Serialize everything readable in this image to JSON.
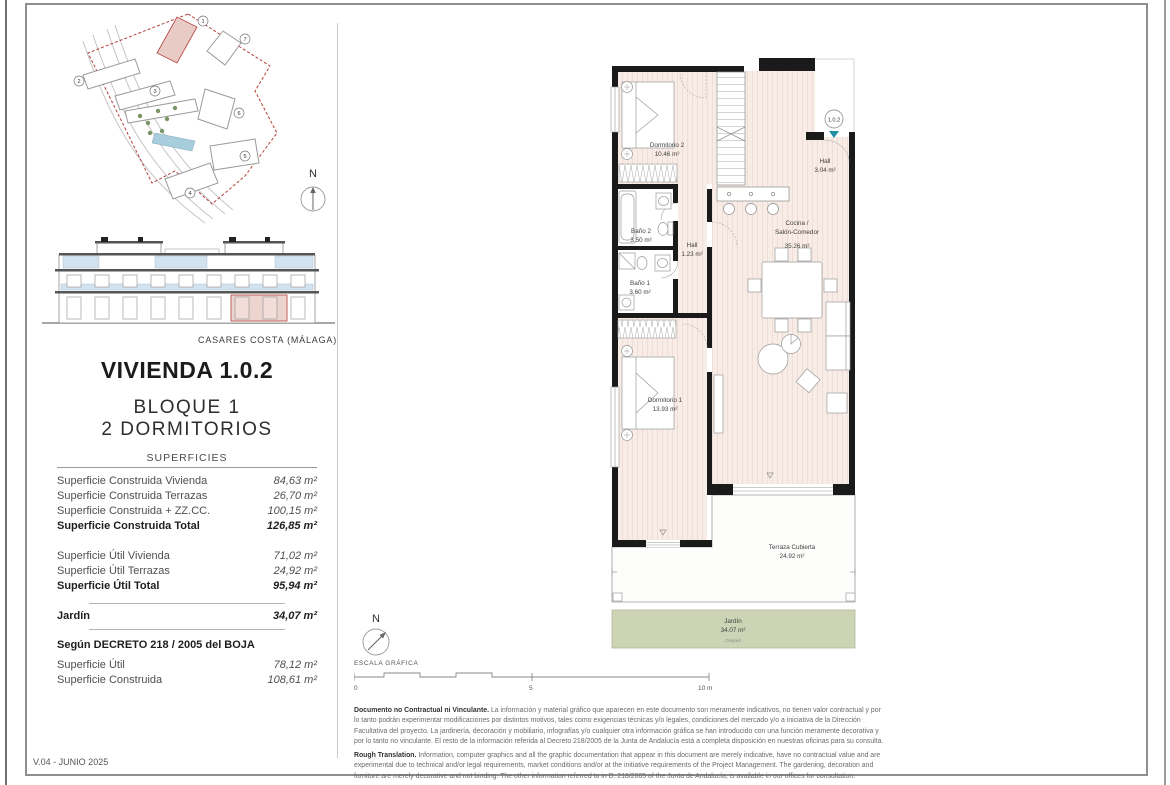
{
  "meta": {
    "version": "V.04 - JUNIO 2025",
    "location": "CASARES COSTA (MÁLAGA)"
  },
  "unit": {
    "title": "VIVIENDA 1.0.2",
    "block": "BLOQUE 1",
    "type": "2 DORMITORIOS",
    "marker": "1.0.2"
  },
  "north": {
    "label": "N"
  },
  "surfaces": {
    "heading": "SUPERFICIES",
    "rows": [
      {
        "label": "Superficie Construida Vivienda",
        "value": "84,63 m²"
      },
      {
        "label": "Superficie Construida Terrazas",
        "value": "26,70 m²"
      },
      {
        "label": "Superficie Construida + ZZ.CC.",
        "value": "100,15 m²"
      },
      {
        "label": "Superficie Construida Total",
        "value": "126,85 m²"
      },
      {
        "label": "Superficie Útil Vivienda",
        "value": "71,02 m²"
      },
      {
        "label": "Superficie Útil Terrazas",
        "value": "24,92 m²"
      },
      {
        "label": "Superficie Útil Total",
        "value": "95,94 m²"
      }
    ],
    "jardin": {
      "label": "Jardín",
      "value": "34,07 m²"
    },
    "decree": {
      "heading": "Según DECRETO 218 / 2005 del BOJA",
      "rows": [
        {
          "label": "Superficie Útil",
          "value": "78,12 m²"
        },
        {
          "label": "Superficie Construida",
          "value": "108,61 m²"
        }
      ]
    }
  },
  "plan": {
    "dormitorio2": {
      "name": "Dormitorio 2",
      "area": "10.46 m²"
    },
    "hall_entrada": {
      "name": "Hall",
      "area": "3.04 m²"
    },
    "cocina": {
      "name1": "Cocina /",
      "name2": "Salón-Comedor",
      "area": "35.26 m²"
    },
    "bano2": {
      "name": "Baño 2",
      "area": "3.50 m²"
    },
    "hall": {
      "name": "Hall",
      "area": "1.23 m²"
    },
    "bano1": {
      "name": "Baño 1",
      "area": "3.60 m²"
    },
    "dormitorio1": {
      "name": "Dormitorio 1",
      "area": "13.93 m²"
    },
    "terraza": {
      "name": "Terraza Cubierta",
      "area": "24.92 m²"
    },
    "jardin": {
      "name": "Jardín",
      "area": "34.07 m²",
      "note": "Césped"
    }
  },
  "site": {
    "numbers": [
      "1",
      "2",
      "3",
      "4",
      "5",
      "6",
      "7"
    ]
  },
  "scale_bar": {
    "label": "ESCALA GRÁFICA",
    "t0": "0",
    "t5": "5",
    "t10": "10 m"
  },
  "disclaimer": {
    "es_lead": "Documento no Contractual ni Vinculante.",
    "es_body": " La información y material gráfico que aparecen en este documento son meramente indicativos, no tienen valor contractual y por lo tanto podrán experimentar modificaciones por distintos motivos, tales como exigencias técnicas y/o legales, condiciones del mercado y/o a iniciativa de la Dirección Facultativa del proyecto. La jardinería, decoración y mobiliario, infografías y/o cualquier otra información gráfica se han introducido con una función meramente decorativa y por lo tanto no vinculante. El resto de la información referida al Decreto 218/2005 de la Junta de Andalucía está a completa disposición en nuestras oficinas para su consulta.",
    "en_lead": "Rough Translation.",
    "en_body": " Information, computer graphics and all the graphic documentation that appear in this document are merely indicative, have no contractual value and are experimental due to technical and/or legal requirements, market conditions and/or at the initiative requirements of the Project Management. The gardening, decoration and furniture are merely decorative and not binding. The other information referred to in D. 218/2005 of the Junta de Andalucía, is available in our offices for consultation."
  },
  "colors": {
    "wall_black": "#1a1a1a",
    "floor_pink": "#f8ece6",
    "garden_green": "#cdd4b6",
    "boundary_red": "#b5413b",
    "glass_blue": "#d3e2ef",
    "entry_teal": "#1e8fa5"
  }
}
